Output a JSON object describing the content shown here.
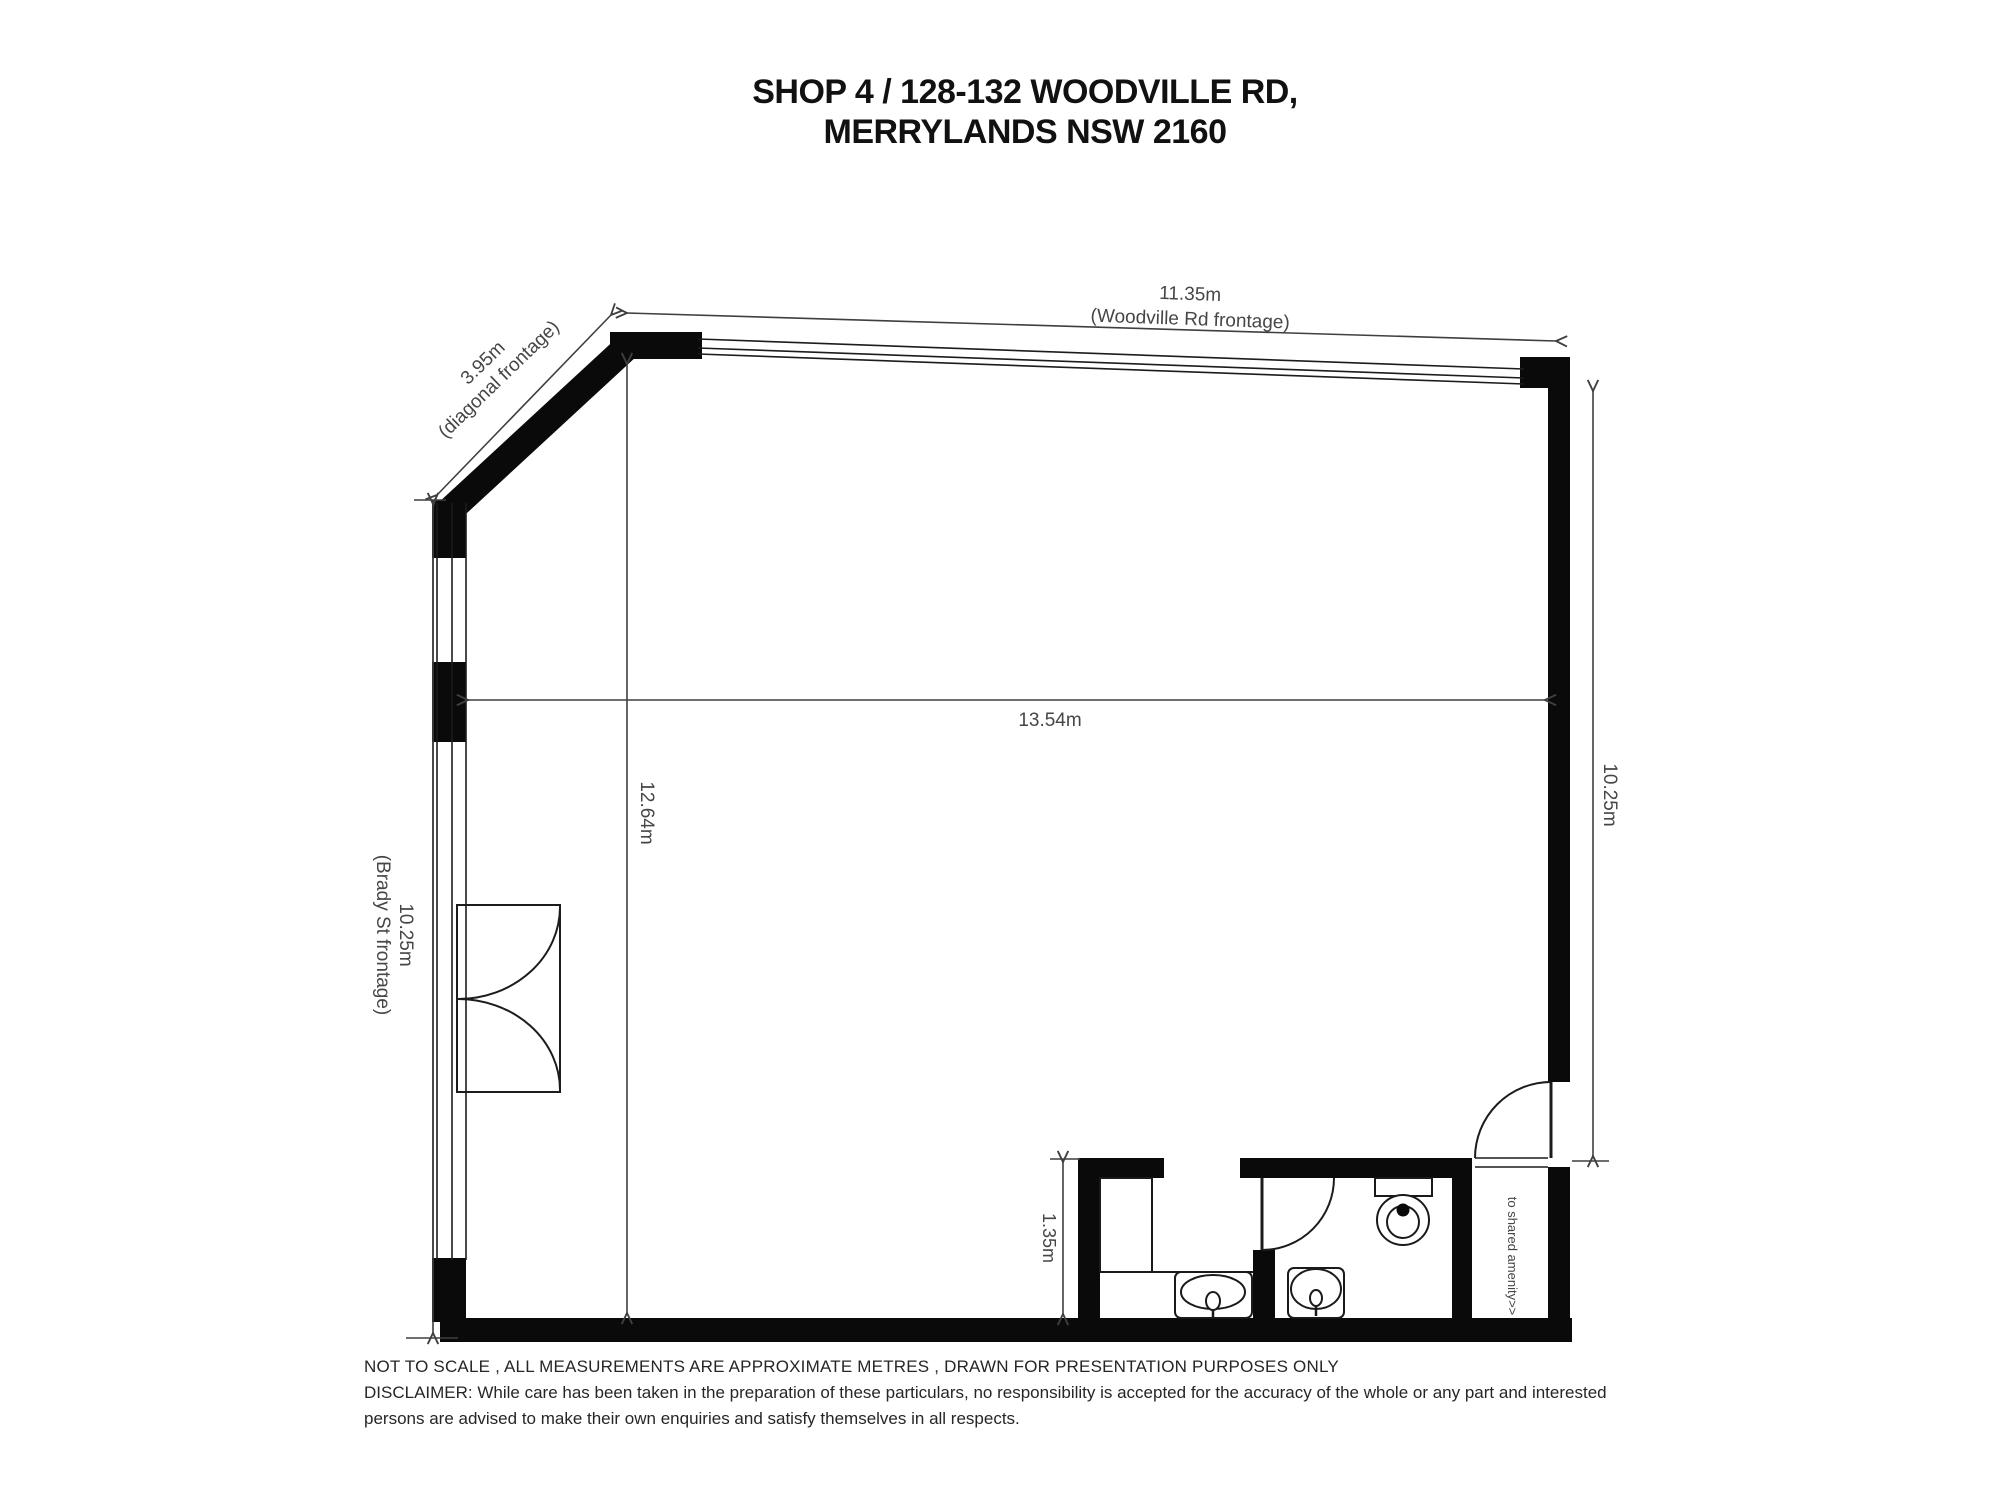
{
  "title": {
    "line1": "SHOP 4 / 128-132 WOODVILLE RD,",
    "line2": "MERRYLANDS NSW 2160"
  },
  "dimensions": {
    "woodville_rd": {
      "value": "11.35m",
      "label": "(Woodville Rd frontage)"
    },
    "diagonal": {
      "value": "3.95m",
      "label": "(diagonal frontage)"
    },
    "brady_st": {
      "value": "10.25m",
      "label": "(Brady St frontage)"
    },
    "interior_depth": {
      "value": "12.64m"
    },
    "interior_width": {
      "value": "13.54m"
    },
    "right_wall": {
      "value": "10.25m"
    },
    "amenities_depth": {
      "value": "1.35m"
    }
  },
  "annotations": {
    "shared_amenity": "to shared amenity>>"
  },
  "footer": {
    "line1": "NOT TO SCALE , ALL MEASUREMENTS ARE APPROXIMATE METRES , DRAWN FOR PRESENTATION PURPOSES ONLY",
    "line2": "DISCLAIMER:  While care has been taken in the preparation of these particulars, no responsibility is accepted for the accuracy of the whole or any part and interested",
    "line3": "persons are advised to make their own enquiries and satisfy  themselves in all respects."
  },
  "colors": {
    "background": "#ffffff",
    "wall": "#0a0a0a",
    "thin_line": "#1c1c1c",
    "dimension_line": "#3f3f3f",
    "dimension_text": "#464646",
    "title_text": "#111111",
    "footer_text": "#262626"
  }
}
